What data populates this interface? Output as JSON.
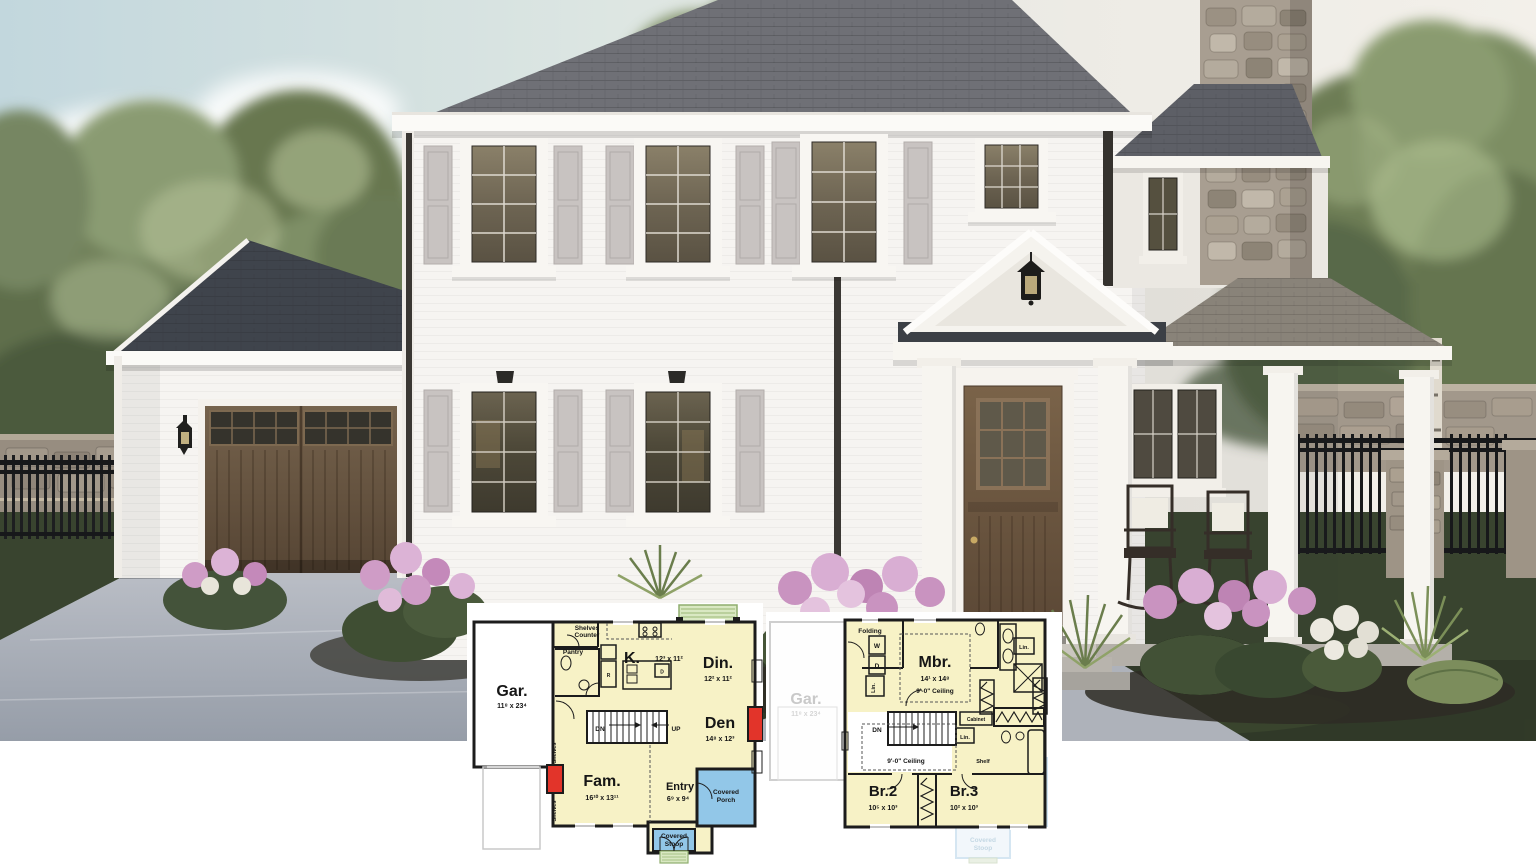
{
  "image_type": "house plan marketing rendering with floor plans",
  "palette": {
    "sky": "#c2d7dd",
    "wall_white": "#f6f4f1",
    "roof": "#6f7076",
    "shutter": "#c8c3c1",
    "door_brown": "#6f5740",
    "grass": "#39442f",
    "driveway": "#a8adb6",
    "stone": "#a89e91",
    "fence_black": "#17181a",
    "flower_pink": "#cf9cc6",
    "plan_interior": "#f7f2c6",
    "plan_porch_blue": "#92c7e8",
    "plan_fireplace_red": "#e2342a",
    "plan_stoop_green": "#d9e8c2"
  },
  "floor1": {
    "garage_name": "Gar.",
    "garage_dims": "11⁸ x 23⁴",
    "kitchen_name": "K.",
    "kitchen_dims": "12³ x 11²",
    "dining_name": "Din.",
    "dining_dims": "12² x 11²",
    "den_name": "Den",
    "den_dims": "14⁸ x 12³",
    "family_name": "Fam.",
    "family_dims": "16¹⁰ x 13¹¹",
    "entry_name": "Entry",
    "entry_dims": "6⁹ x 9⁴",
    "shelves": "Shelves",
    "counter": "Counter",
    "pantry": "Pantry",
    "fridge": "R",
    "dishwasher": "D",
    "down": "DN",
    "up": "UP",
    "shelves_left_a": "Shelves",
    "shelves_left_b": "Shelves",
    "porch_l1": "Covered",
    "porch_l2": "Porch",
    "stoop_l1": "Covered",
    "stoop_l2": "Stoop"
  },
  "floor2": {
    "master_name": "Mbr.",
    "master_dims": "14¹ x 14⁸",
    "master_ceiling": "9'-0\" Ceiling",
    "br2_name": "Br.2",
    "br2_dims": "10⁵ x 10³",
    "br3_name": "Br.3",
    "br3_dims": "10² x 10³",
    "folding": "Folding",
    "washer": "W",
    "dryer": "D",
    "lin1": "Lin.",
    "lin2": "Lin.",
    "lin3": "Lin.",
    "down": "DN",
    "hall_ceiling": "9'-0\" Ceiling",
    "cabinet": "Cabinet",
    "shelf": "Shelf",
    "ghost_garage_name": "Gar.",
    "ghost_garage_dims": "11⁸ x 23⁴",
    "ghost_porch_l1": "Covered",
    "ghost_porch_l2": "Porch",
    "ghost_stoop_l1": "Covered",
    "ghost_stoop_l2": "Stoop"
  }
}
